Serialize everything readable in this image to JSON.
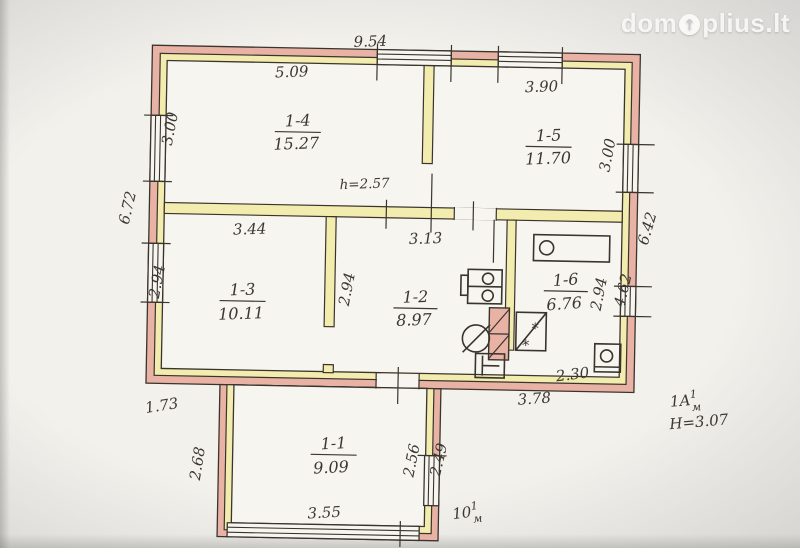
{
  "watermark": {
    "prefix": "dom",
    "suffix": "plius.lt",
    "arrow": "↑"
  },
  "rooms": [
    {
      "number": "1-1",
      "area": "9.09"
    },
    {
      "number": "1-2",
      "area": "8.97"
    },
    {
      "number": "1-3",
      "area": "10.11"
    },
    {
      "number": "1-4",
      "area": "15.27"
    },
    {
      "number": "1-5",
      "area": "11.70"
    },
    {
      "number": "1-6",
      "area": "6.76"
    }
  ],
  "dims": {
    "top_overall": "9.54",
    "room14_w": "5.09",
    "room15_w": "3.90",
    "room14_h_left": "3.00",
    "room15_h_right": "3.00",
    "left_outer": "6.72",
    "room13_w": "3.44",
    "room13_h": "2.94",
    "room12_w": "3.13",
    "room12_h": "2.94",
    "ceiling_note": "h=2.57",
    "room16_w": "2.30",
    "room16_h": "2.94",
    "right_wall_lower": "4.62",
    "right_outer": "6.42",
    "bottom_left": "1.73",
    "bottom_right": "3.78",
    "annex_h_left": "2.68",
    "annex_h_inner": "2.56",
    "annex_h_outer": "2.49",
    "annex_w": "3.55",
    "building_note": "1A",
    "building_note_sup": "1",
    "building_note_sub": "м",
    "height_note": "H=3.07",
    "scale_note": "10",
    "scale_note_sup": "1",
    "scale_note_sub": "м"
  },
  "colors": {
    "wall_fill": "#e8b2a5",
    "partition_fill": "#f2ecae",
    "line": "#3a342e",
    "paper": "#f7f5ef",
    "ink": "#3c3732",
    "bg_outer": "#cbcac8",
    "bg_inner": "#f3f1ec",
    "watermark": "rgba(250,250,248,0.92)"
  }
}
